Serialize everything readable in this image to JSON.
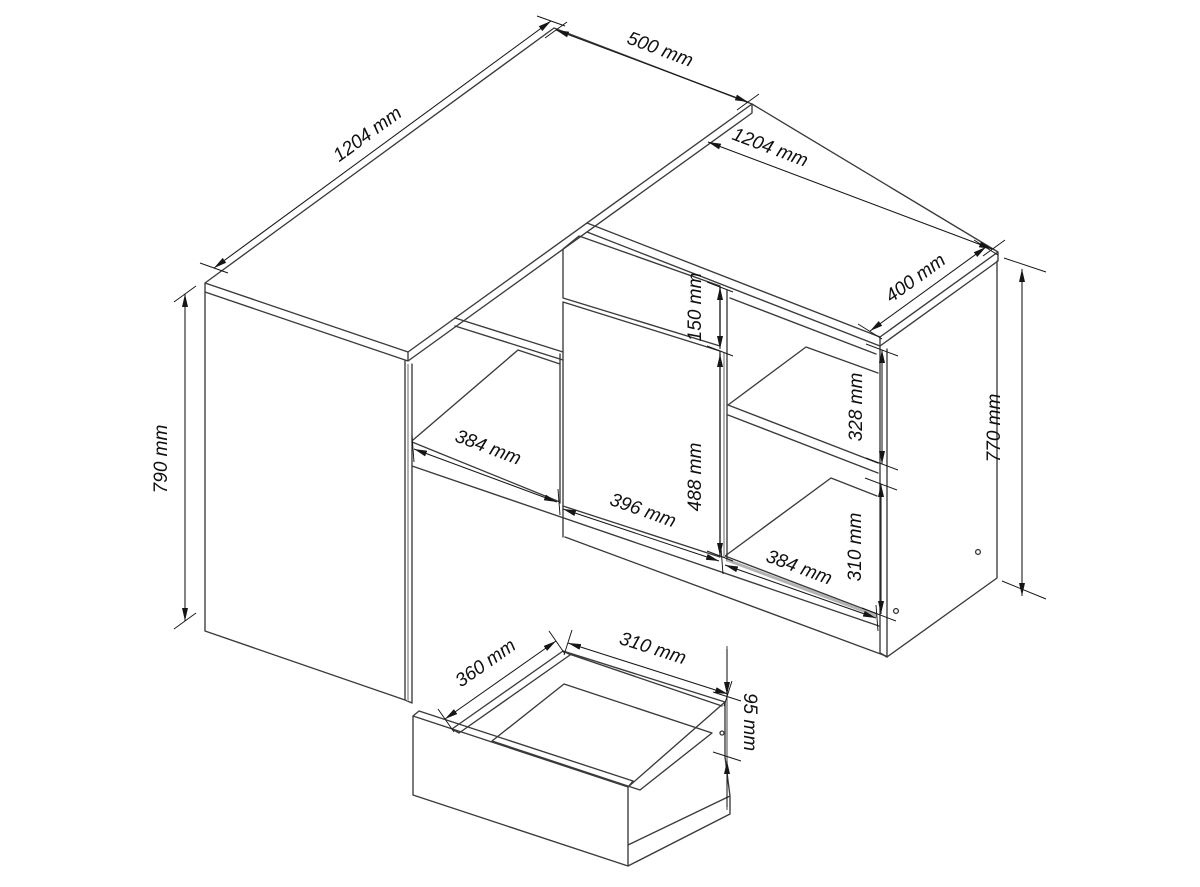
{
  "drawing": {
    "desk": {
      "length": "1204 mm",
      "depth": "500 mm",
      "height": "790 mm"
    },
    "cabinet": {
      "length": "1204 mm",
      "depth": "400 mm",
      "height": "770 mm",
      "drawer_front_height": "150 mm",
      "door_width": "396 mm",
      "door_height": "488 mm",
      "left_opening_width": "384 mm",
      "right_opening_width": "384 mm",
      "upper_opening_height": "328 mm",
      "lower_opening_height": "310 mm"
    },
    "drawer": {
      "depth": "360 mm",
      "width": "310 mm",
      "height": "95 mm"
    }
  },
  "style": {
    "line_color": "#3a3a3a",
    "dimension_color": "#161616",
    "shade_color": "#b3b3b3",
    "background": "#ffffff"
  }
}
